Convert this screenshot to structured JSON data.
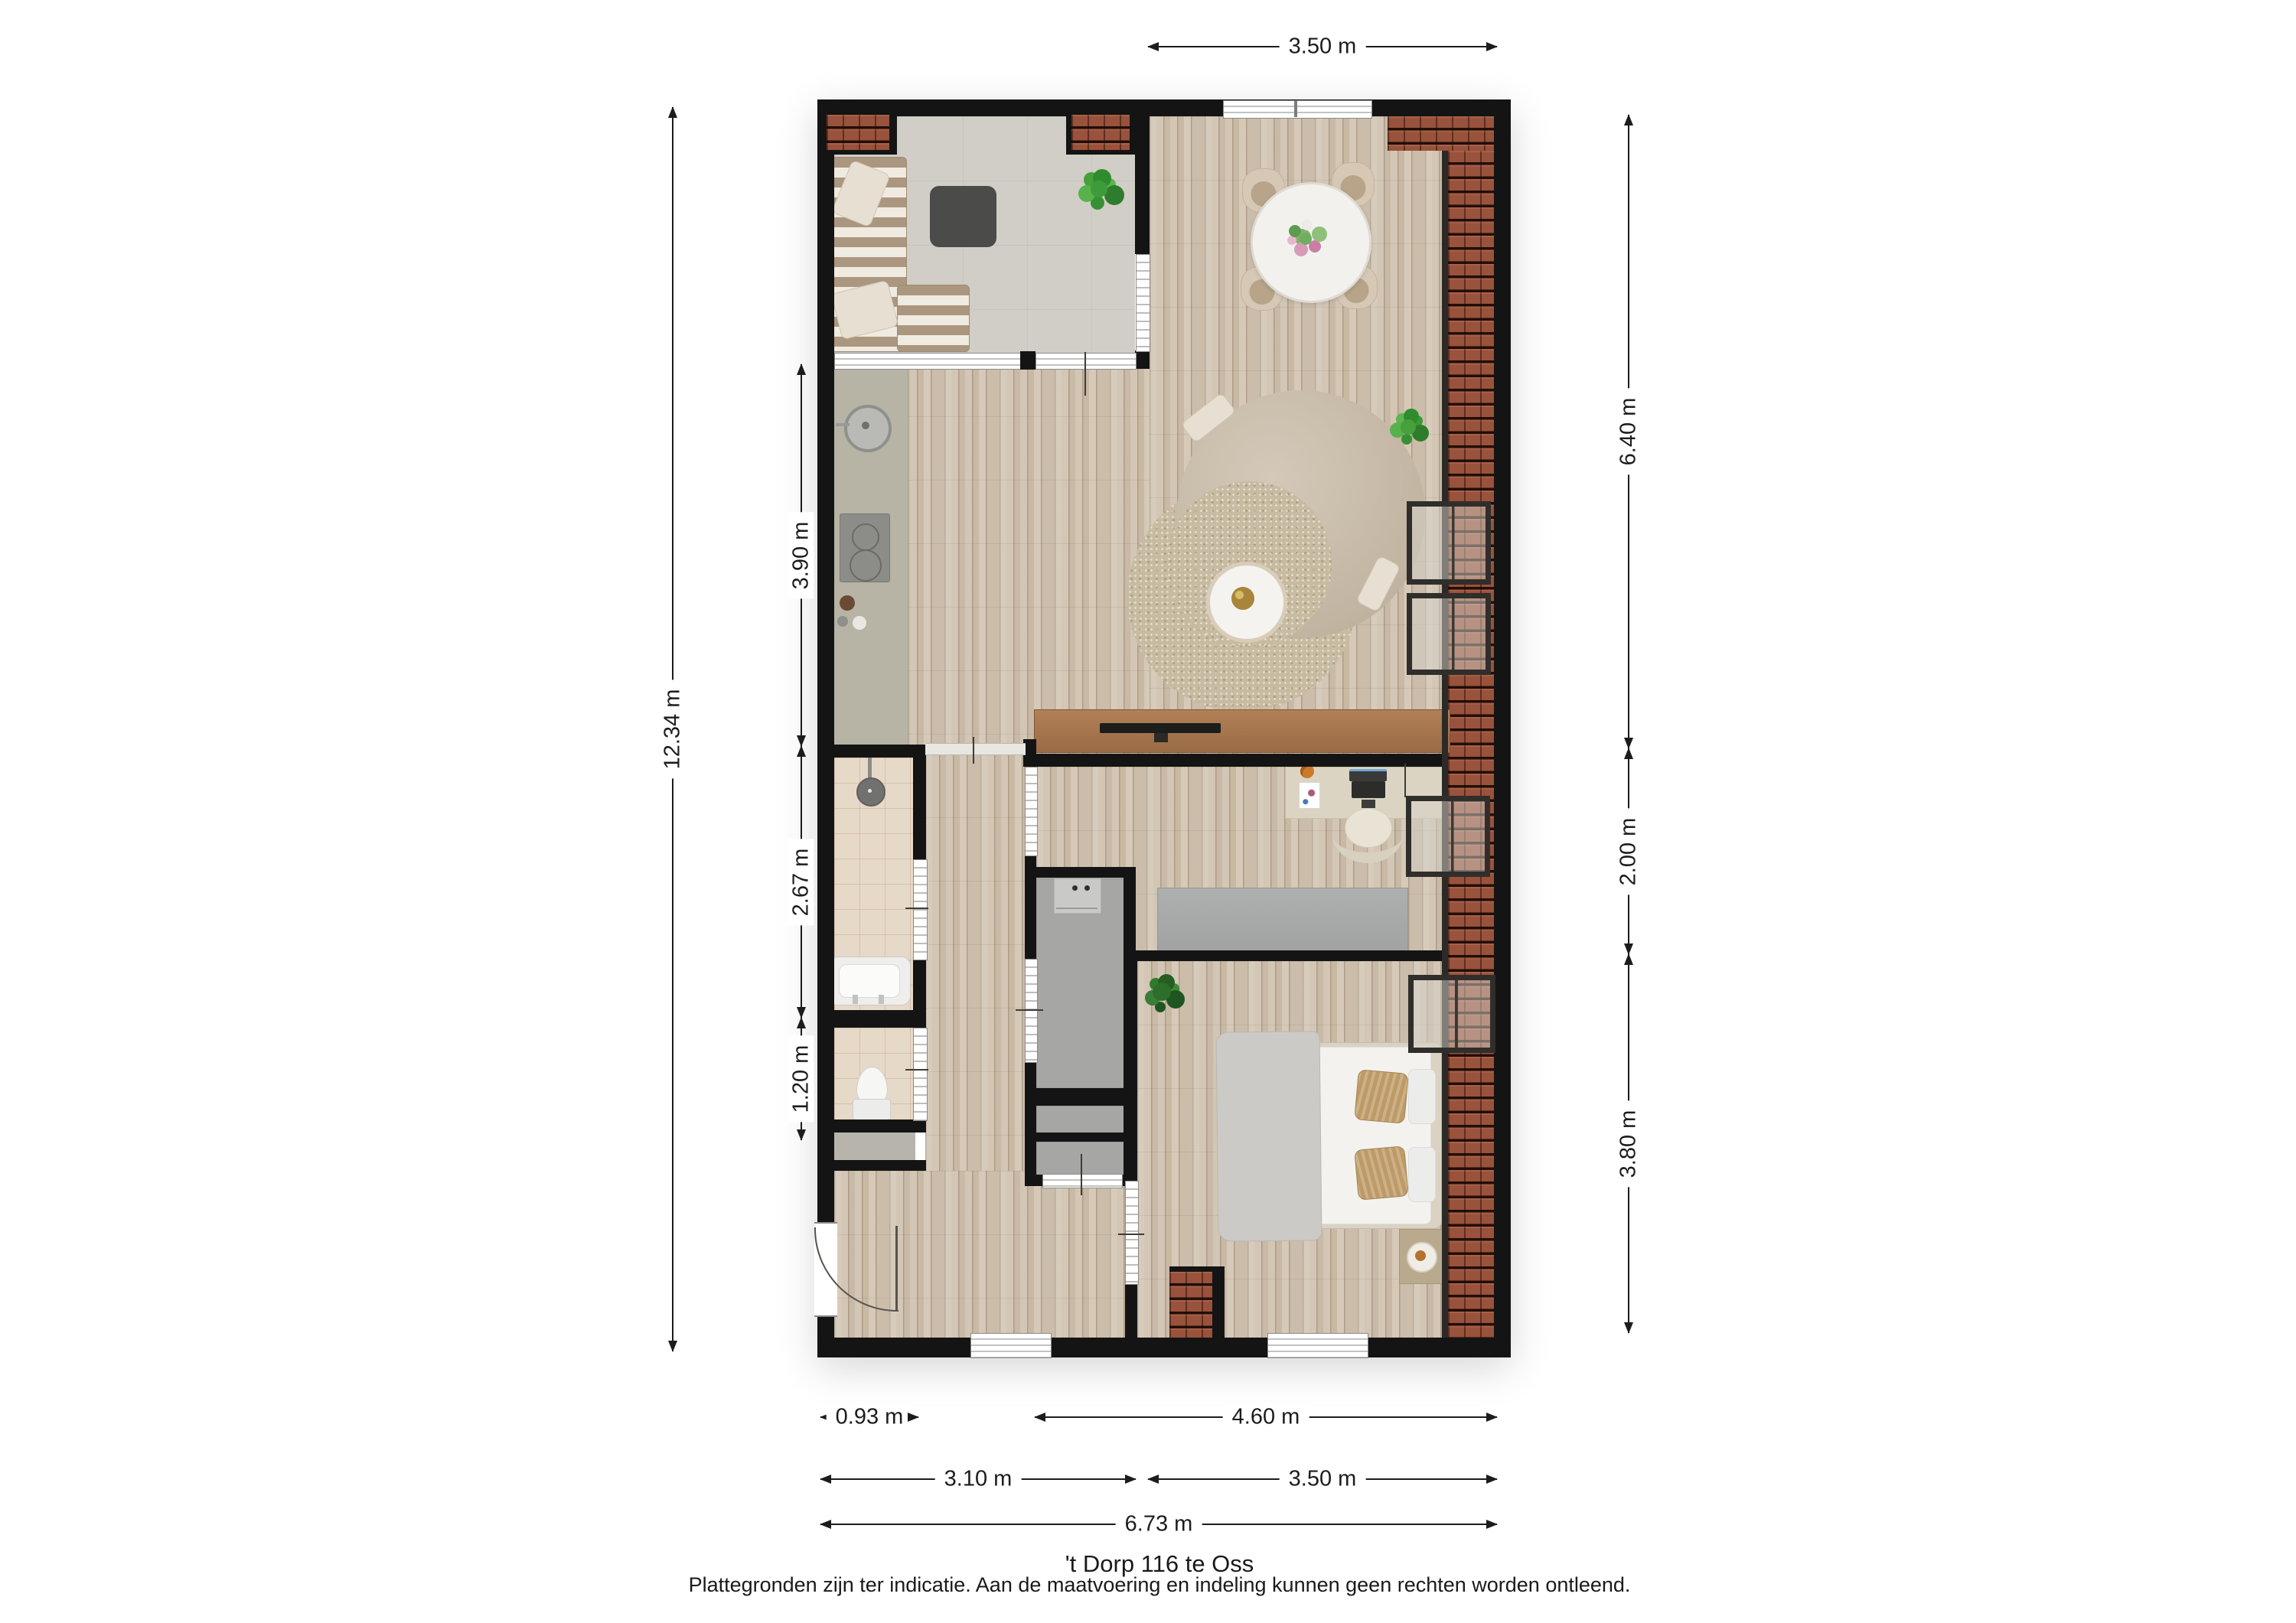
{
  "floorplan": {
    "caption": {
      "title": "'t Dorp 116 te Oss",
      "disclaimer": "Plattegronden zijn ter indicatie. Aan de maatvoering en indeling kunnen geen rechten worden ontleend."
    },
    "dimensions": {
      "top_width": "3.50 m",
      "left_total_height": "12.34 m",
      "left_kitchen": "3.90 m",
      "left_bathroom": "2.67 m",
      "left_toilet": "1.20 m",
      "right_living": "6.40 m",
      "right_office": "2.00 m",
      "right_bedroom": "3.80 m",
      "bottom_entrance": "0.93 m",
      "bottom_bedroom_zone": "4.60 m",
      "bottom_left_width": "3.10 m",
      "bottom_right_width": "3.50 m",
      "bottom_total_width": "6.73 m"
    },
    "colors": {
      "wall": "#141414",
      "roof_tiles": "#99523b",
      "wood_floor": "#d3c6b4",
      "balcony_floor": "#d0cec6",
      "bathroom_floor": "#e6d9c8",
      "kitchen_counter": "#b7b3a5",
      "sofa": "#c8bcab",
      "rug": "#c7bba2",
      "dimension_text": "#1c1c1c"
    }
  }
}
